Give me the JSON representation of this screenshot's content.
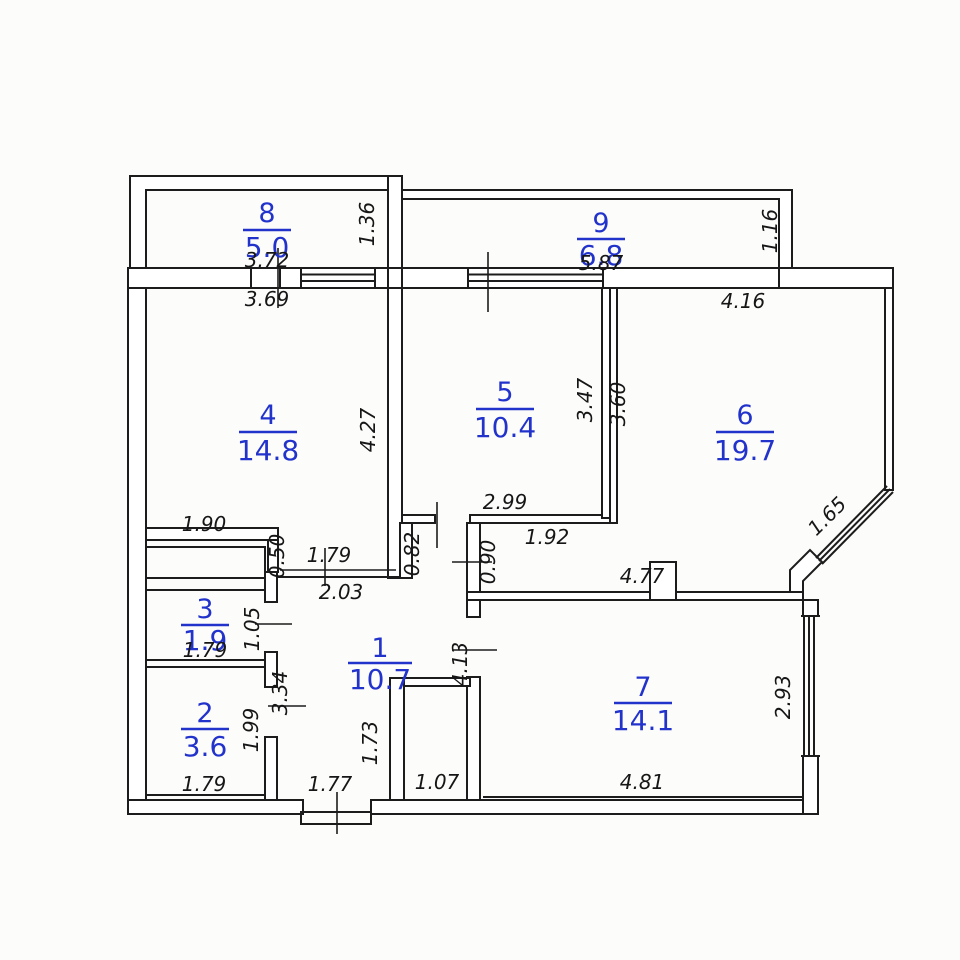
{
  "colors": {
    "wall": "#1c1c1c",
    "dim_text": "#161616",
    "room_label": "#2233cc",
    "background": "#fcfcfb"
  },
  "rooms": [
    {
      "number": "1",
      "area": "10.7"
    },
    {
      "number": "2",
      "area": "3.6"
    },
    {
      "number": "3",
      "area": "1.9"
    },
    {
      "number": "4",
      "area": "14.8"
    },
    {
      "number": "5",
      "area": "10.4"
    },
    {
      "number": "6",
      "area": "19.7"
    },
    {
      "number": "7",
      "area": "14.1"
    },
    {
      "number": "8",
      "area": "5.0"
    },
    {
      "number": "9",
      "area": "6.8"
    }
  ],
  "dimensions": [
    {
      "text": "3.72"
    },
    {
      "text": "3.69"
    },
    {
      "text": "1.36"
    },
    {
      "text": "5.87"
    },
    {
      "text": "1.16"
    },
    {
      "text": "4.16"
    },
    {
      "text": "4.27"
    },
    {
      "text": "3.47"
    },
    {
      "text": "3.60"
    },
    {
      "text": "1.90"
    },
    {
      "text": "0.50"
    },
    {
      "text": "1.79"
    },
    {
      "text": "2.03"
    },
    {
      "text": "0.82"
    },
    {
      "text": "2.99"
    },
    {
      "text": "0.90"
    },
    {
      "text": "1.92"
    },
    {
      "text": "4.77"
    },
    {
      "text": "1.65"
    },
    {
      "text": "1.05"
    },
    {
      "text": "1.79"
    },
    {
      "text": "3.34"
    },
    {
      "text": "1.99"
    },
    {
      "text": "1.79"
    },
    {
      "text": "1.73"
    },
    {
      "text": "1.77"
    },
    {
      "text": "1.07"
    },
    {
      "text": "4.81"
    },
    {
      "text": "4.13"
    },
    {
      "text": "2.93"
    }
  ]
}
